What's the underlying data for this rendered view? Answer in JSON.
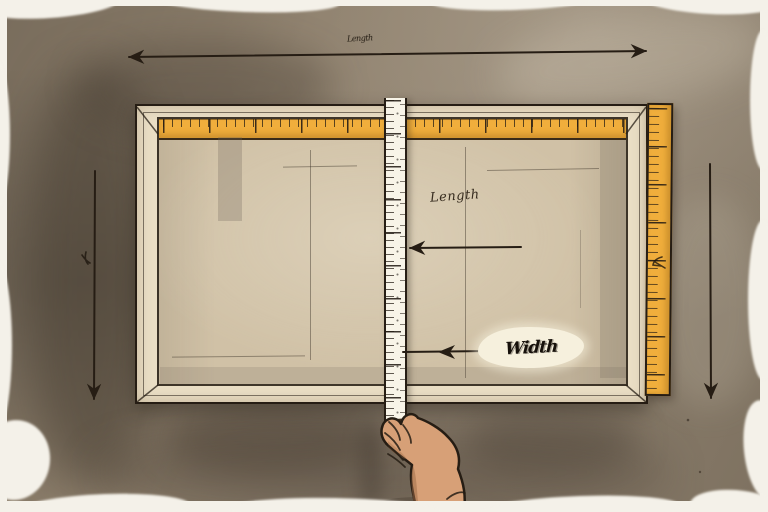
{
  "labels": {
    "top_dimension": "Length",
    "length": "Length",
    "width": "Width"
  },
  "colors": {
    "wall": "#8c7e6b",
    "wallShadow": "#5f5445",
    "paper": "#f4f1e9",
    "frame": "#eadec5",
    "interior": "#d0c1a6",
    "ruler": "#f0ae3c",
    "tape": "#f8f4e8",
    "ink": "#261d14",
    "skin": "#d7a077",
    "skinShadow": "#9c6a45",
    "patch": "#f6f0dd"
  },
  "scene": {
    "objects": [
      "picture-frame",
      "top-ruler",
      "right-ruler",
      "measuring-tape",
      "hand",
      "length-arrow",
      "width-arrow",
      "dimension-lines"
    ]
  }
}
